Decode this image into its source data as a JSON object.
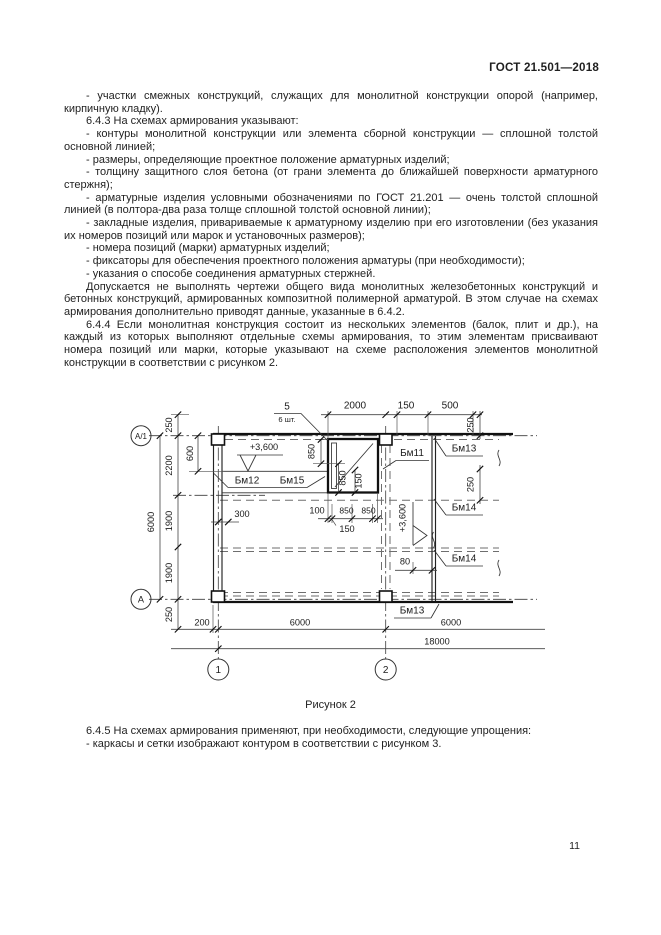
{
  "header": {
    "title": "ГОСТ 21.501—2018"
  },
  "page_number": "11",
  "body": {
    "paragraphs": [
      "- участки смежных конструкций, служащих для монолитной конструкции опорой (например, кирпичную кладку).",
      "6.4.3 На схемах армирования указывают:",
      "- контуры монолитной конструкции или элемента сборной конструкции — сплошной толстой основной линией;",
      "- размеры, определяющие проектное положение арматурных изделий;",
      "- толщину защитного слоя бетона (от грани элемента до ближайшей поверхности арматурного стержня);",
      "- арматурные изделия условными обозначениями по ГОСТ 21.201 — очень толстой сплошной линией (в полтора-два раза толще сплошной толстой основной линии);",
      "- закладные изделия, привариваемые к арматурному изделию при его изготовлении (без указания их номеров позиций или марок и установочных размеров);",
      "- номера позиций (марки) арматурных изделий;",
      "- фиксаторы для обеспечения проектного положения арматуры (при необходимости);",
      "- указания о способе соединения арматурных стержней.",
      "Допускается не выполнять чертежи общего вида монолитных железобетонных конструкций и бетонных конструкций, армированных композитной полимерной арматурой. В этом случае на схемах армирования дополнительно приводят данные, указанные в 6.4.2.",
      "6.4.4 Если монолитная конструкция состоит из нескольких элементов (балок, плит и др.), на каждый из которых выполняют отдельные схемы армирования, то этим элементам присваивают номера позиций или марки, которые указывают на схеме расположения элементов монолитной конструкции в соответствии с рисунком 2."
    ],
    "figure_caption": "Рисунок 2",
    "after_paragraphs": [
      "6.4.5 На схемах армирования применяют, при необходимости, следующие упрощения:",
      "- каркасы и сетки изображают контуром в соответствии с рисунком 3."
    ]
  },
  "figure": {
    "bubbles": {
      "a1": "А/1",
      "a": "А",
      "one": "1",
      "two": "2"
    },
    "beams": {
      "bm11": "Бм11",
      "bm12": "Бм12",
      "bm13_top": "Бм13",
      "bm13_bottom": "Бм13",
      "bm14_upper": "Бм14",
      "bm14_lower": "Бм14",
      "bm15": "Бм15"
    },
    "position": {
      "number": "5",
      "count": "6 шт."
    },
    "elevations": {
      "top": "+3,600",
      "middle": "+3,600"
    },
    "dims": {
      "top": {
        "d2000": "2000",
        "d150": "150",
        "d500": "500",
        "d250_right": "250"
      },
      "left": {
        "d250_top": "250",
        "d600": "600",
        "d2200": "2200",
        "d6000": "6000",
        "d1900_upper": "1900",
        "d1900_lower": "1900",
        "d250_bottom": "250"
      },
      "opening": {
        "d850_left": "850",
        "d850_inner": "850",
        "d150_inner": "150",
        "d100": "100",
        "d850_a": "850",
        "d850_b": "850",
        "d150_below": "150"
      },
      "middle": {
        "d300": "300",
        "d250": "250",
        "d80": "80"
      },
      "bottom": {
        "d200": "200",
        "d6000_left": "6000",
        "d6000_right": "6000",
        "d18000": "18000"
      }
    }
  }
}
